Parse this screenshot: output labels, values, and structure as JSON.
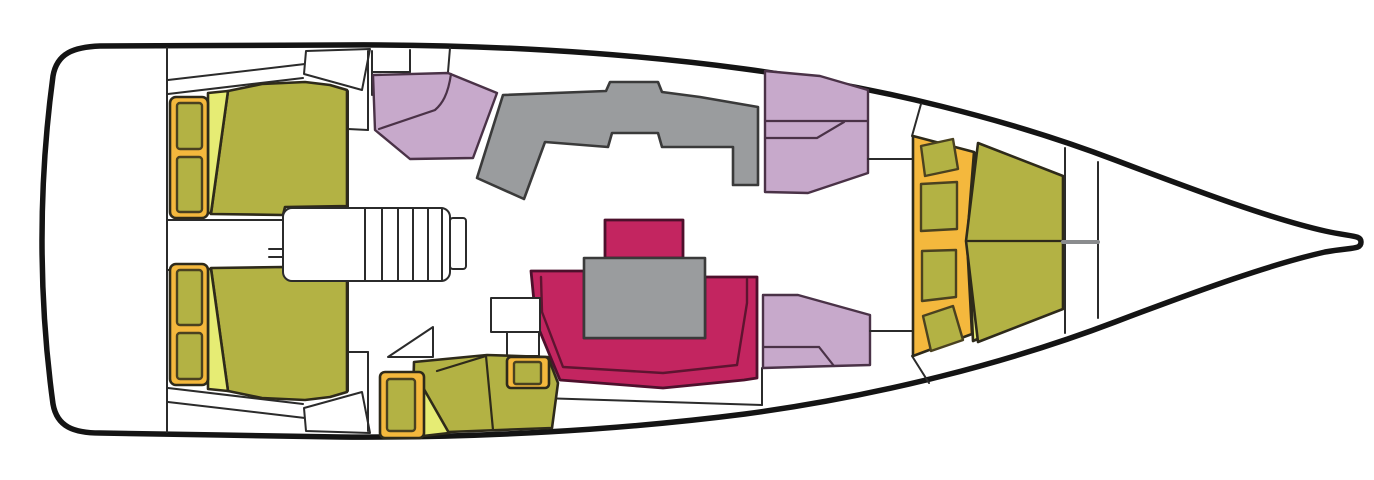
{
  "meta": {
    "title": "Sailboat interior deck floor plan",
    "diagram_type": "yacht-floorplan-top-view",
    "orientation": "bow-right-stern-left",
    "canvas": {
      "width": 1374,
      "height": 480
    }
  },
  "palette": {
    "background": "#ffffff",
    "hull_line": "#141414",
    "structure_line": "#2b2b2b",
    "white": "#ffffff",
    "olive": "#b3b244",
    "wedge": "#e6ec74",
    "orange": "#f4b83d",
    "purple": "#c7a9cb",
    "gray": "#9a9c9e",
    "crimson": "#c32560"
  },
  "areas": [
    {
      "id": "stern-transom",
      "label": "Stern / transom platform",
      "color_key": "white"
    },
    {
      "id": "aft-cabin-port",
      "label": "Aft cabin (upper) with double berth",
      "color_key": "olive"
    },
    {
      "id": "aft-cabin-starboard",
      "label": "Aft cabin (lower) with double berth",
      "color_key": "olive"
    },
    {
      "id": "companionway",
      "label": "Companionway steps / engine box",
      "color_key": "white"
    },
    {
      "id": "galley",
      "label": "Galley counter",
      "color_key": "gray"
    },
    {
      "id": "seat-aft-port",
      "label": "Galley-side seat (upper left)",
      "color_key": "purple"
    },
    {
      "id": "seat-fwd-port",
      "label": "Saloon seat (upper right)",
      "color_key": "purple"
    },
    {
      "id": "seat-fwd-starboard",
      "label": "Saloon seat (lower right)",
      "color_key": "purple"
    },
    {
      "id": "dinette",
      "label": "Saloon dinette with U-settee and table",
      "color_key": "crimson"
    },
    {
      "id": "nav-station",
      "label": "Chart table and navigation seat",
      "color_key": "olive"
    },
    {
      "id": "forward-cabin",
      "label": "Forward cabin V-berth",
      "color_key": "olive"
    },
    {
      "id": "bow-locker",
      "label": "Bow anchor locker",
      "color_key": "white"
    }
  ]
}
